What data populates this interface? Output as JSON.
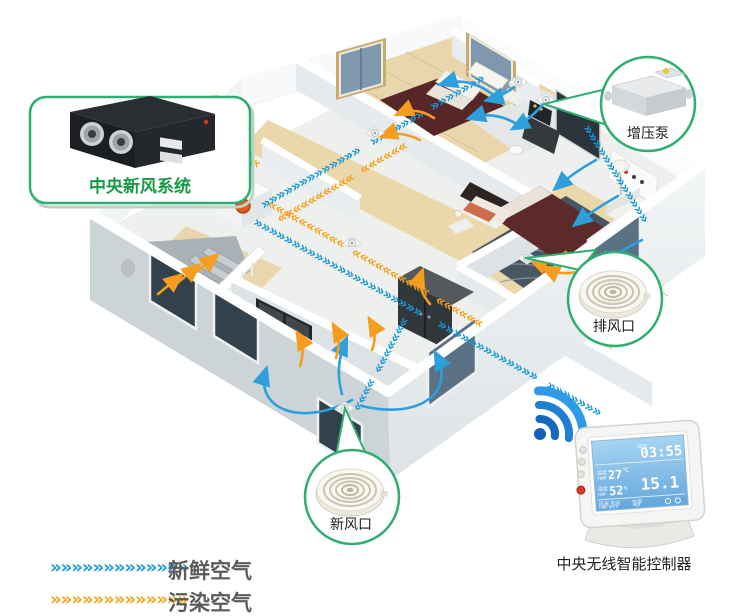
{
  "callouts": {
    "hrv": {
      "label": "中央新风系统"
    },
    "booster": {
      "label": "增压泵"
    },
    "exhaust_vent": {
      "label": "排风口"
    },
    "fresh_vent": {
      "label": "新风口"
    }
  },
  "controller": {
    "label": "中央无线智能控制器",
    "screen": {
      "day": "WED",
      "time": "03:55",
      "temp_label": "温度",
      "temp_label_en": "TEMP",
      "temp_value": "27",
      "temp_unit": "℃",
      "hum_label": "湿度",
      "hum_label_en": "HUM",
      "hum_value": "52",
      "hum_unit": "%",
      "main_value": "15.1",
      "fan_label": "风速 自动",
      "fan_label_en": "FAN AUTO",
      "mode_label": "中速",
      "mode_label_en": "MED"
    }
  },
  "legend": {
    "fresh": {
      "label": "新鲜空气",
      "color": "#189ad6"
    },
    "polluted": {
      "label": "污染空气",
      "color": "#f5a11d"
    }
  },
  "flow_glyphs": {
    "long": "»»»»»»»»»»»»»»»»»»»»»»",
    "med": "»»»»»»»»»»»»»",
    "short": "»»»»»»»",
    "tiny": "»»»»",
    "rev_med": "««««««««««",
    "rev_short": "««««««",
    "legend_row": "»»»»»»»»»»»»»"
  },
  "colors": {
    "fresh_blue": "#189ad6",
    "polluted_orange": "#f5a11d",
    "callout_green": "#2fae72",
    "hrv_label_green": "#169a44"
  }
}
